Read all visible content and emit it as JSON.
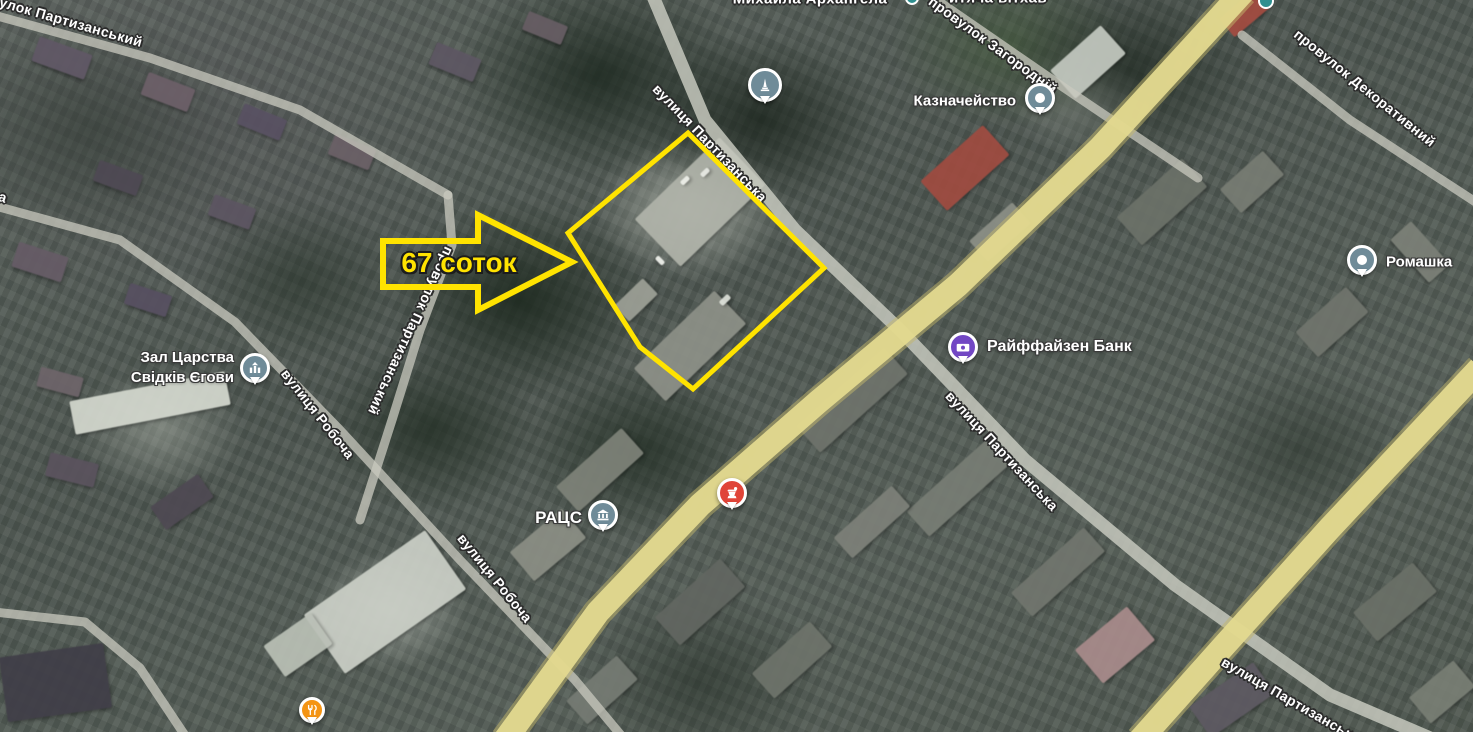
{
  "annotation": {
    "plot_size_label": "67 соток",
    "outline_color": "#ffe300"
  },
  "street_labels": {
    "top_left_lane": "провулок Партизанський",
    "church_top_cut": "Михайла Архангела",
    "top_cut_fragment": "итяча вітхав",
    "zahorodnii": "провулок Загородній",
    "dekoratyvnyi": "провулок Декоративний",
    "partyzanska_top": "вулиця Партизанська",
    "partyzanskyi_lane_vertical": "провулок Партизанський",
    "robocha_upper": "вулиця Робоча",
    "robocha_lower": "вулиця Робоча",
    "partyzanska_right": "вулиця Партизанська",
    "partyzanska_bottom_cut": "вулиця Партизанська",
    "left_edge_fragment": "а"
  },
  "pois": {
    "treasury": {
      "label": "Казначейство",
      "pin_color": "#6f8b98"
    },
    "romashka": {
      "label": "Ромашка",
      "pin_color": "#6f8b98"
    },
    "raiffeisen_bank": {
      "label": "Райффайзен Банк",
      "pin_color": "#7247c4"
    },
    "ratss": {
      "label": "РАЦС",
      "pin_color": "#6f8b98"
    },
    "kingdom_hall": {
      "label_line1": "Зал Царства",
      "label_line2": "Свідків Єгови",
      "pin_color": "#6f8b98"
    },
    "monument": {
      "pin_color": "#6f8b98"
    },
    "pharmacy": {
      "pin_color": "#e04438"
    },
    "restaurant": {
      "pin_color": "#f49413"
    },
    "top_edge_icon_1": {
      "pin_color": "#2f8f8f"
    },
    "top_edge_icon_2": {
      "pin_color": "#2f8f8f"
    }
  },
  "map_colors": {
    "road_yellow": "#e3d98f",
    "road_gray": "#c9cabf",
    "annotation_yellow": "#ffe300"
  }
}
